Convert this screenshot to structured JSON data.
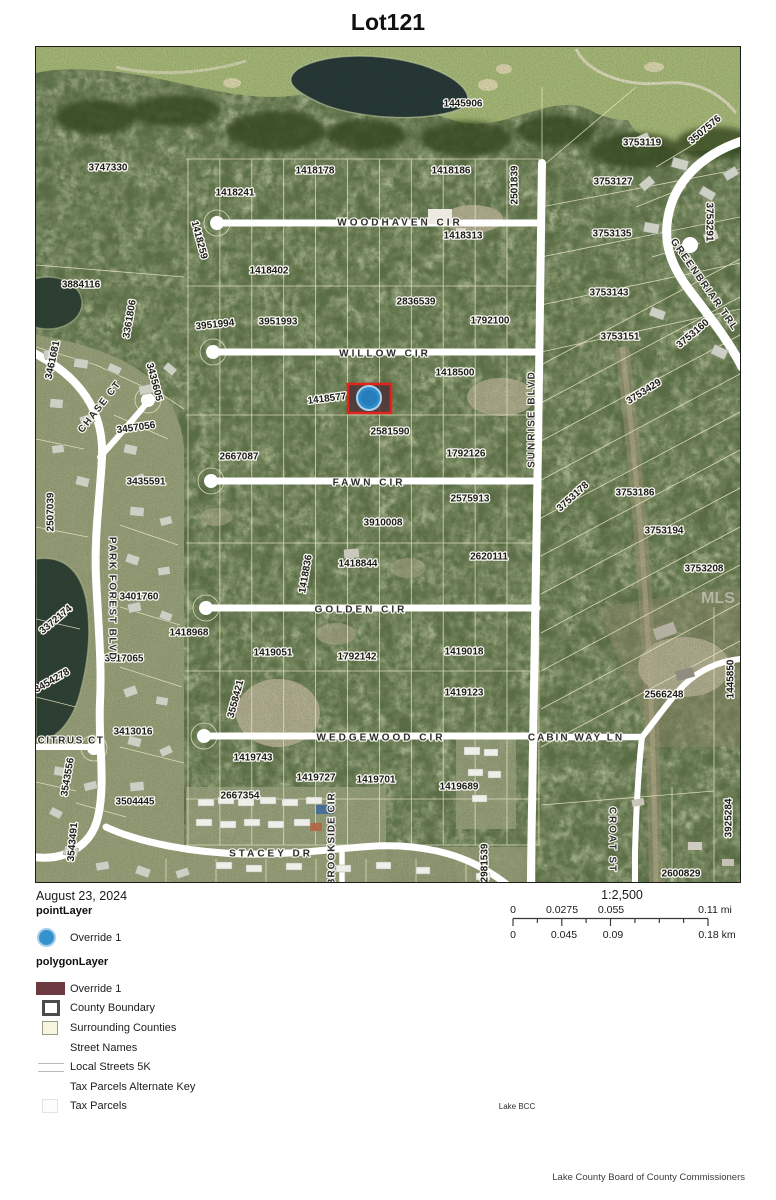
{
  "title": "Lot121",
  "info": {
    "date": "August 23, 2024",
    "scale_ratio": "1:2,500",
    "scale_mi": [
      "0",
      "0.0275",
      "0.055",
      "0.11 mi"
    ],
    "scale_km": [
      "0",
      "0.045",
      "0.09",
      "0.18 km"
    ]
  },
  "legend": {
    "point_header": "pointLayer",
    "point_items": [
      {
        "label": "Override 1",
        "swatch": "point"
      }
    ],
    "polygon_header": "polygonLayer",
    "polygon_items": [
      {
        "label": "Override 1",
        "swatch": "maroon"
      },
      {
        "label": "County Boundary",
        "swatch": "county"
      },
      {
        "label": "Surrounding Counties",
        "swatch": "surrounding"
      },
      {
        "label": "Street Names",
        "swatch": "none"
      },
      {
        "label": "Local Streets 5K",
        "swatch": "doubleline"
      },
      {
        "label": "Tax Parcels Alternate Key",
        "swatch": "none"
      },
      {
        "label": "Tax Parcels",
        "swatch": "faint"
      }
    ]
  },
  "footer": {
    "center_note": "Lake BCC",
    "attribution": "Lake County Board of County Commissioners"
  },
  "map": {
    "watermark": "MLS",
    "colors": {
      "highlight_border": "#e3241c",
      "highlight_fill": "#4e3238",
      "marker_fill": "#2e8bc9",
      "marker_ring": "#aed4ec"
    },
    "parcels": [
      {
        "t": "3747330",
        "x": 72,
        "y": 121
      },
      {
        "t": "1418178",
        "x": 279,
        "y": 124
      },
      {
        "t": "1418241",
        "x": 199,
        "y": 146
      },
      {
        "t": "1418259",
        "x": 163,
        "y": 193,
        "r": 75
      },
      {
        "t": "1418402",
        "x": 233,
        "y": 224
      },
      {
        "t": "3884116",
        "x": 45,
        "y": 238
      },
      {
        "t": "3361806",
        "x": 94,
        "y": 272,
        "r": -80
      },
      {
        "t": "3951994",
        "x": 179,
        "y": 278,
        "r": -6
      },
      {
        "t": "3951993",
        "x": 242,
        "y": 275
      },
      {
        "t": "2836539",
        "x": 380,
        "y": 255
      },
      {
        "t": "1792100",
        "x": 454,
        "y": 274
      },
      {
        "t": "1445906",
        "x": 427,
        "y": 57
      },
      {
        "t": "3507576",
        "x": 669,
        "y": 83,
        "r": -40
      },
      {
        "t": "3753119",
        "x": 606,
        "y": 96
      },
      {
        "t": "1418186",
        "x": 415,
        "y": 124
      },
      {
        "t": "2501839",
        "x": 479,
        "y": 138,
        "r": -90
      },
      {
        "t": "3753127",
        "x": 577,
        "y": 135
      },
      {
        "t": "1418313",
        "x": 427,
        "y": 189
      },
      {
        "t": "3753135",
        "x": 576,
        "y": 187
      },
      {
        "t": "3753291",
        "x": 673,
        "y": 175,
        "r": 90
      },
      {
        "t": "3753143",
        "x": 573,
        "y": 246
      },
      {
        "t": "3753151",
        "x": 584,
        "y": 290
      },
      {
        "t": "3753160",
        "x": 657,
        "y": 287,
        "r": -40
      },
      {
        "t": "3461681",
        "x": 17,
        "y": 313,
        "r": -78
      },
      {
        "t": "3435605",
        "x": 118,
        "y": 335,
        "r": 75
      },
      {
        "t": "1418577",
        "x": 291,
        "y": 352,
        "r": -7
      },
      {
        "t": "1418500",
        "x": 419,
        "y": 326
      },
      {
        "t": "3753429",
        "x": 608,
        "y": 345,
        "r": -32
      },
      {
        "t": "3457056",
        "x": 100,
        "y": 381,
        "r": -8
      },
      {
        "t": "2581590",
        "x": 354,
        "y": 385
      },
      {
        "t": "2667087",
        "x": 203,
        "y": 410
      },
      {
        "t": "1792126",
        "x": 430,
        "y": 407
      },
      {
        "t": "3435591",
        "x": 110,
        "y": 435
      },
      {
        "t": "2507039",
        "x": 15,
        "y": 465,
        "r": -90
      },
      {
        "t": "2575913",
        "x": 434,
        "y": 452
      },
      {
        "t": "3753178",
        "x": 537,
        "y": 450,
        "r": -42
      },
      {
        "t": "3753186",
        "x": 599,
        "y": 446
      },
      {
        "t": "3753194",
        "x": 628,
        "y": 484
      },
      {
        "t": "3910008",
        "x": 347,
        "y": 476
      },
      {
        "t": "3753208",
        "x": 668,
        "y": 522
      },
      {
        "t": "1418836",
        "x": 270,
        "y": 527,
        "r": -80
      },
      {
        "t": "1418844",
        "x": 322,
        "y": 517
      },
      {
        "t": "2620111",
        "x": 453,
        "y": 510
      },
      {
        "t": "3401760",
        "x": 103,
        "y": 550
      },
      {
        "t": "3372174",
        "x": 20,
        "y": 573,
        "r": -40
      },
      {
        "t": "1418968",
        "x": 153,
        "y": 586
      },
      {
        "t": "3817065",
        "x": 88,
        "y": 612
      },
      {
        "t": "1419051",
        "x": 237,
        "y": 606
      },
      {
        "t": "1792142",
        "x": 321,
        "y": 610
      },
      {
        "t": "3454278",
        "x": 16,
        "y": 634,
        "r": -30
      },
      {
        "t": "3558421",
        "x": 200,
        "y": 652,
        "r": -75
      },
      {
        "t": "1419018",
        "x": 428,
        "y": 605
      },
      {
        "t": "1445850",
        "x": 695,
        "y": 632,
        "r": -90
      },
      {
        "t": "3413016",
        "x": 97,
        "y": 685
      },
      {
        "t": "1419743",
        "x": 217,
        "y": 711
      },
      {
        "t": "1419123",
        "x": 428,
        "y": 646
      },
      {
        "t": "2566248",
        "x": 628,
        "y": 648
      },
      {
        "t": "3543556",
        "x": 32,
        "y": 730,
        "r": -80
      },
      {
        "t": "1419727",
        "x": 280,
        "y": 731
      },
      {
        "t": "1419701",
        "x": 340,
        "y": 733
      },
      {
        "t": "2667354",
        "x": 204,
        "y": 749
      },
      {
        "t": "3504445",
        "x": 99,
        "y": 755
      },
      {
        "t": "1419689",
        "x": 423,
        "y": 740
      },
      {
        "t": "3925284",
        "x": 693,
        "y": 771,
        "r": -90
      },
      {
        "t": "3543491",
        "x": 37,
        "y": 795,
        "r": -85
      },
      {
        "t": "2981539",
        "x": 449,
        "y": 816,
        "r": -90
      },
      {
        "t": "2600829",
        "x": 645,
        "y": 827
      }
    ],
    "streets": [
      {
        "t": "WOODHAVEN CIR",
        "x": 364,
        "y": 176,
        "ls": 3
      },
      {
        "t": "WILLOW CIR",
        "x": 349,
        "y": 307,
        "ls": 3
      },
      {
        "t": "FAWN CIR",
        "x": 333,
        "y": 436,
        "ls": 3
      },
      {
        "t": "GOLDEN CIR",
        "x": 325,
        "y": 563,
        "ls": 3
      },
      {
        "t": "WEDGEWOOD CIR",
        "x": 345,
        "y": 691,
        "ls": 3
      },
      {
        "t": "CABIN WAY LN",
        "x": 540,
        "y": 691,
        "ls": 2
      },
      {
        "t": "STACEY DR",
        "x": 235,
        "y": 807,
        "ls": 3
      },
      {
        "t": "SUNRISE BLVD",
        "x": 496,
        "y": 372,
        "r": -90,
        "ls": 2
      },
      {
        "t": "CROAT ST",
        "x": 576,
        "y": 793,
        "r": 90,
        "ls": 2
      },
      {
        "t": "BROOKSIDE CIR",
        "x": 296,
        "y": 792,
        "r": -90,
        "ls": 1
      },
      {
        "t": "PARK FOREST BLVD",
        "x": 76,
        "y": 552,
        "r": 90,
        "ls": 1.5
      },
      {
        "t": "CHASE CT",
        "x": 64,
        "y": 360,
        "r": -52,
        "ls": 1.5
      },
      {
        "t": "CITRUS CT",
        "x": 35,
        "y": 694,
        "ls": 1.5
      },
      {
        "t": "GREENBRIAR TRL",
        "x": 668,
        "y": 238,
        "r": 55,
        "ls": 1.5
      }
    ]
  }
}
